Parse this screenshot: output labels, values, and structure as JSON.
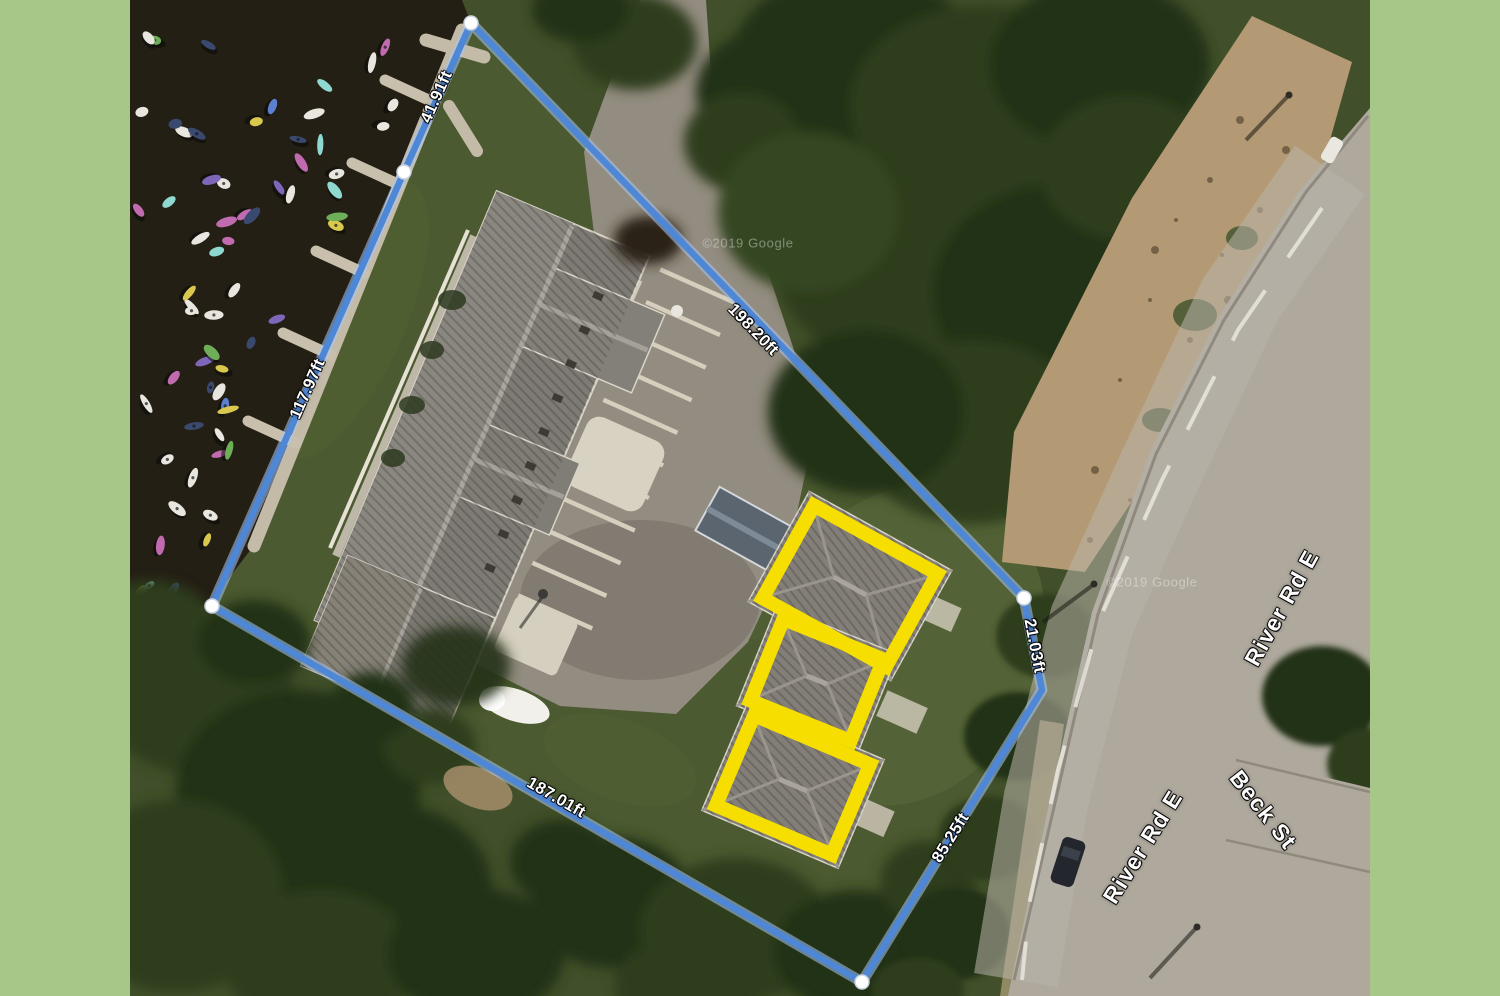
{
  "frame": {
    "color": "#a6c787"
  },
  "scene": {
    "colors": {
      "water": "#241f15",
      "grass": "#4b5a30",
      "pavement": "#938c80",
      "road": "#aea89d",
      "dirt": "#b49a74",
      "roof": "#7e7a74",
      "dock": "#c3bba8",
      "tree": "#2d3c1e"
    },
    "watermarks": [
      {
        "text": "©2019 Google",
        "x": 748,
        "y": 243,
        "rot": 0
      },
      {
        "text": "©2019 Google",
        "x": 1152,
        "y": 582,
        "rot": 0
      }
    ]
  },
  "parcel": {
    "line_color": "#4f87d7",
    "halo_color": "#a9c7f0",
    "vertices": [
      [
        471,
        23
      ],
      [
        404,
        172
      ],
      [
        212,
        606
      ],
      [
        862,
        982
      ],
      [
        1042,
        690
      ],
      [
        1024,
        598
      ]
    ],
    "handle_indices": [
      0,
      1,
      2,
      3,
      5
    ],
    "measurements": [
      {
        "label": "41.91ft",
        "x": 437,
        "y": 97,
        "rot": -66
      },
      {
        "label": "117.97ft",
        "x": 308,
        "y": 389,
        "rot": -66
      },
      {
        "label": "198.20ft",
        "x": 753,
        "y": 330,
        "rot": 46
      },
      {
        "label": "187.01ft",
        "x": 556,
        "y": 798,
        "rot": 30
      },
      {
        "label": "21.03ft",
        "x": 1034,
        "y": 646,
        "rot": 79
      },
      {
        "label": "85.25ft",
        "x": 951,
        "y": 838,
        "rot": -58
      }
    ]
  },
  "highlights": {
    "color": "#f6df00",
    "boxes": [
      {
        "cx": 850,
        "cy": 586,
        "w": 155,
        "h": 120,
        "rot": 29
      },
      {
        "cx": 817,
        "cy": 680,
        "w": 122,
        "h": 102,
        "rot": 22
      },
      {
        "cx": 793,
        "cy": 785,
        "w": 140,
        "h": 112,
        "rot": 23
      }
    ]
  },
  "roads": {
    "labels": [
      {
        "text": "River Rd E",
        "x": 1282,
        "y": 608,
        "rot": -61
      },
      {
        "text": "River Rd E",
        "x": 1143,
        "y": 847,
        "rot": -58
      },
      {
        "text": "Beck St",
        "x": 1263,
        "y": 810,
        "rot": 52
      }
    ]
  }
}
